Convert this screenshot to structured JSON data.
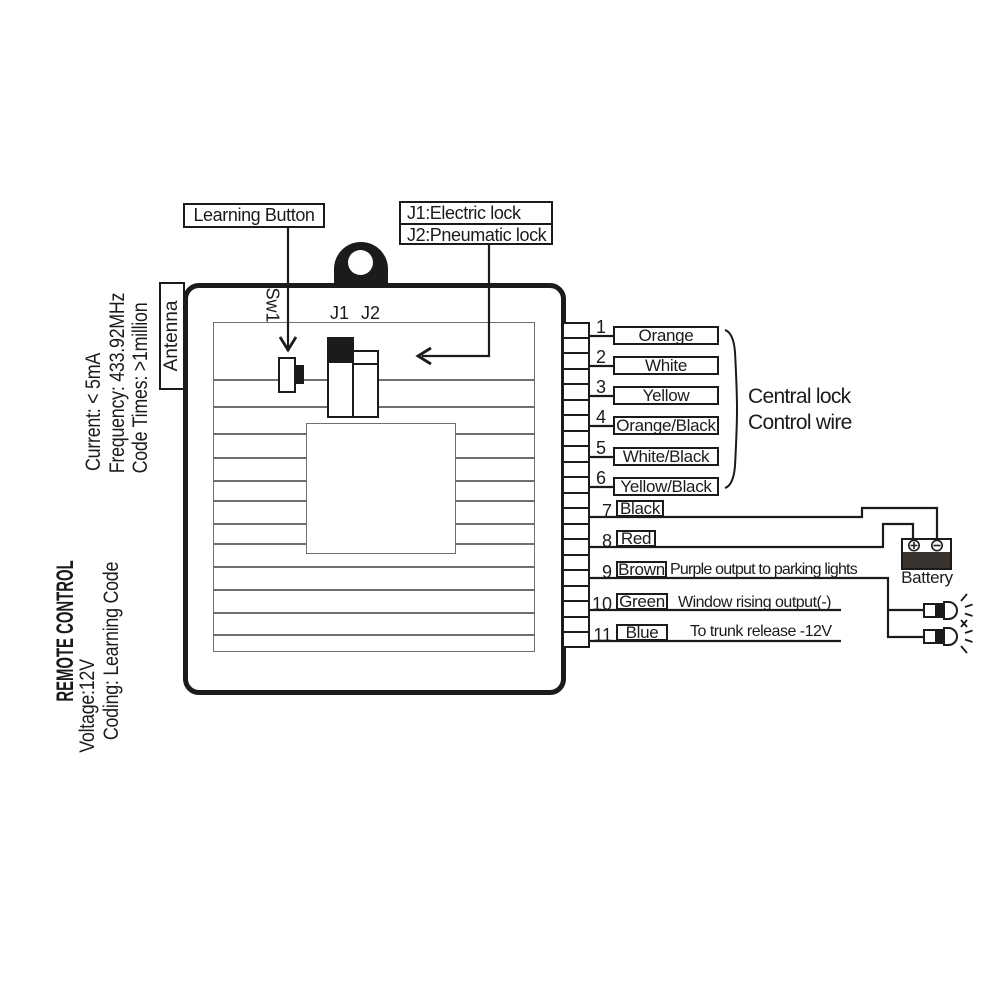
{
  "callouts": {
    "learning_button": "Learning Button",
    "jumper_line1": "J1:Electric lock",
    "jumper_line2": "J2:Pneumatic lock"
  },
  "board": {
    "sw1_label": "Sw1",
    "j1_label": "J1",
    "j2_label": "J2",
    "antenna_label": "Antenna"
  },
  "specs": {
    "current": "Current:  < 5mA",
    "frequency": "Frequency: 433.92MHz",
    "code_times": "Code Times: >1million"
  },
  "product": {
    "name": "REMOTE CONTROL",
    "voltage": "Voltage:12V",
    "coding": "Coding: Learning Code"
  },
  "wires": [
    {
      "num": "1",
      "color": "Orange",
      "note": ""
    },
    {
      "num": "2",
      "color": "White",
      "note": ""
    },
    {
      "num": "3",
      "color": "Yellow",
      "note": ""
    },
    {
      "num": "4",
      "color": "Orange/Black",
      "note": ""
    },
    {
      "num": "5",
      "color": "White/Black",
      "note": ""
    },
    {
      "num": "6",
      "color": "Yellow/Black",
      "note": ""
    },
    {
      "num": "7",
      "color": "Black",
      "note": ""
    },
    {
      "num": "8",
      "color": "Red",
      "note": ""
    },
    {
      "num": "9",
      "color": "Brown",
      "note": "Purple output to parking lights"
    },
    {
      "num": "10",
      "color": "Green",
      "note": "Window rising output(-)"
    },
    {
      "num": "11",
      "color": "Blue",
      "note": "To trunk release -12V"
    }
  ],
  "group_label": {
    "line1": "Central lock",
    "line2": "Control wire"
  },
  "battery": {
    "label": "Battery",
    "plus_sign": "+",
    "minus_sign": "−"
  },
  "colors": {
    "ink": "#1b1b1b",
    "trace_gray": "#6f6f6f",
    "battery_fill": "#3a3430",
    "paper": "#ffffff"
  }
}
